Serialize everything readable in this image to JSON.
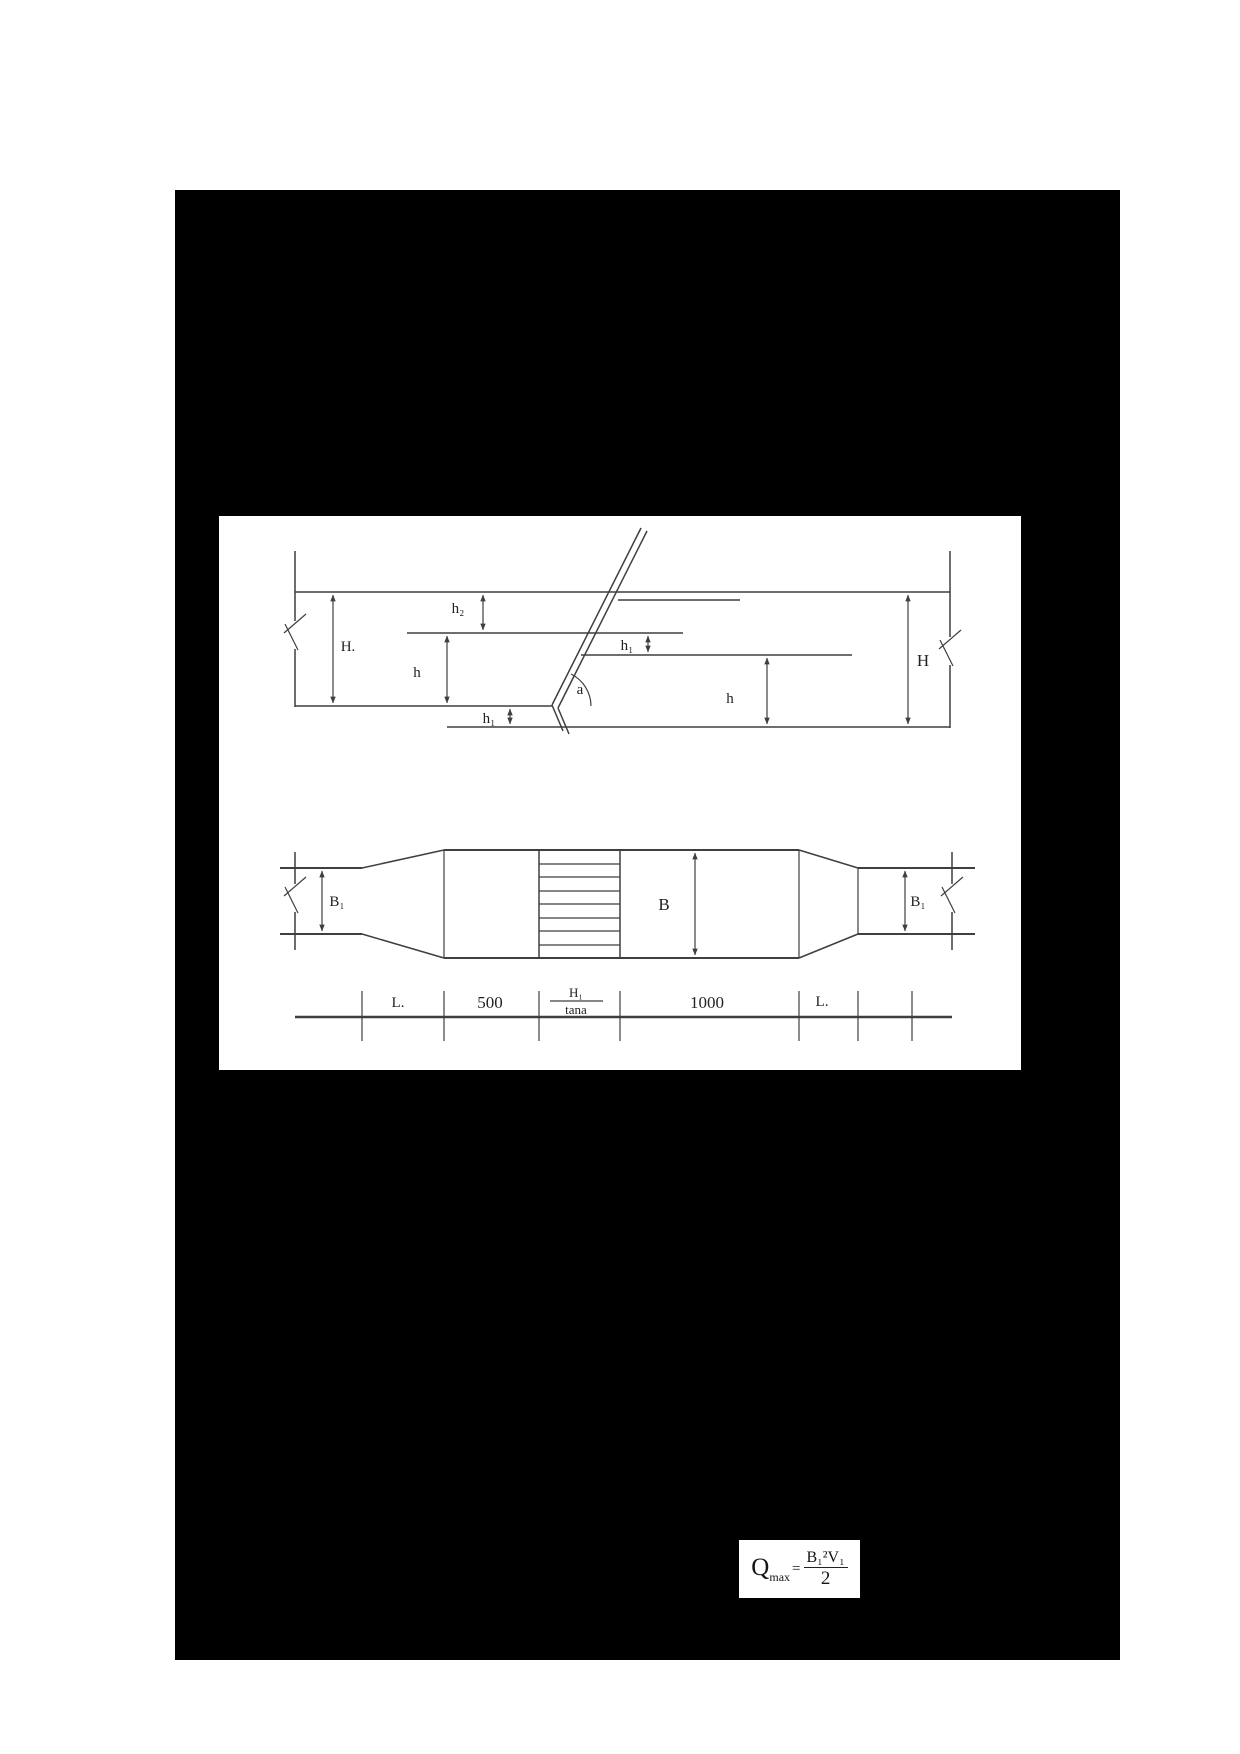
{
  "colors": {
    "paper": "#ffffff",
    "redaction": "#000000",
    "ink": "#3f3f3f",
    "text": "#222222"
  },
  "figure": {
    "profile_labels": {
      "upstream_head": "H.",
      "h2": "h₂",
      "h_upstream": "h",
      "h1_right": "h₁",
      "angle": "a",
      "h_downstream": "h",
      "downstream_head": "H",
      "h1_bottom": "h₁"
    },
    "plan_labels": {
      "b1_left": "B₁",
      "b_center": "B",
      "b1_right": "B₁"
    },
    "dimension_labels": {
      "l_left": "L.",
      "seg_500": "500",
      "frac_numerator": "H₁",
      "frac_denominator": "tana",
      "seg_1000": "1000",
      "l_right": "L."
    }
  },
  "formula": {
    "q_base": "Q",
    "q_sub": "max",
    "equals": "=",
    "numerator": "B₁²V₁",
    "denominator": "2"
  }
}
